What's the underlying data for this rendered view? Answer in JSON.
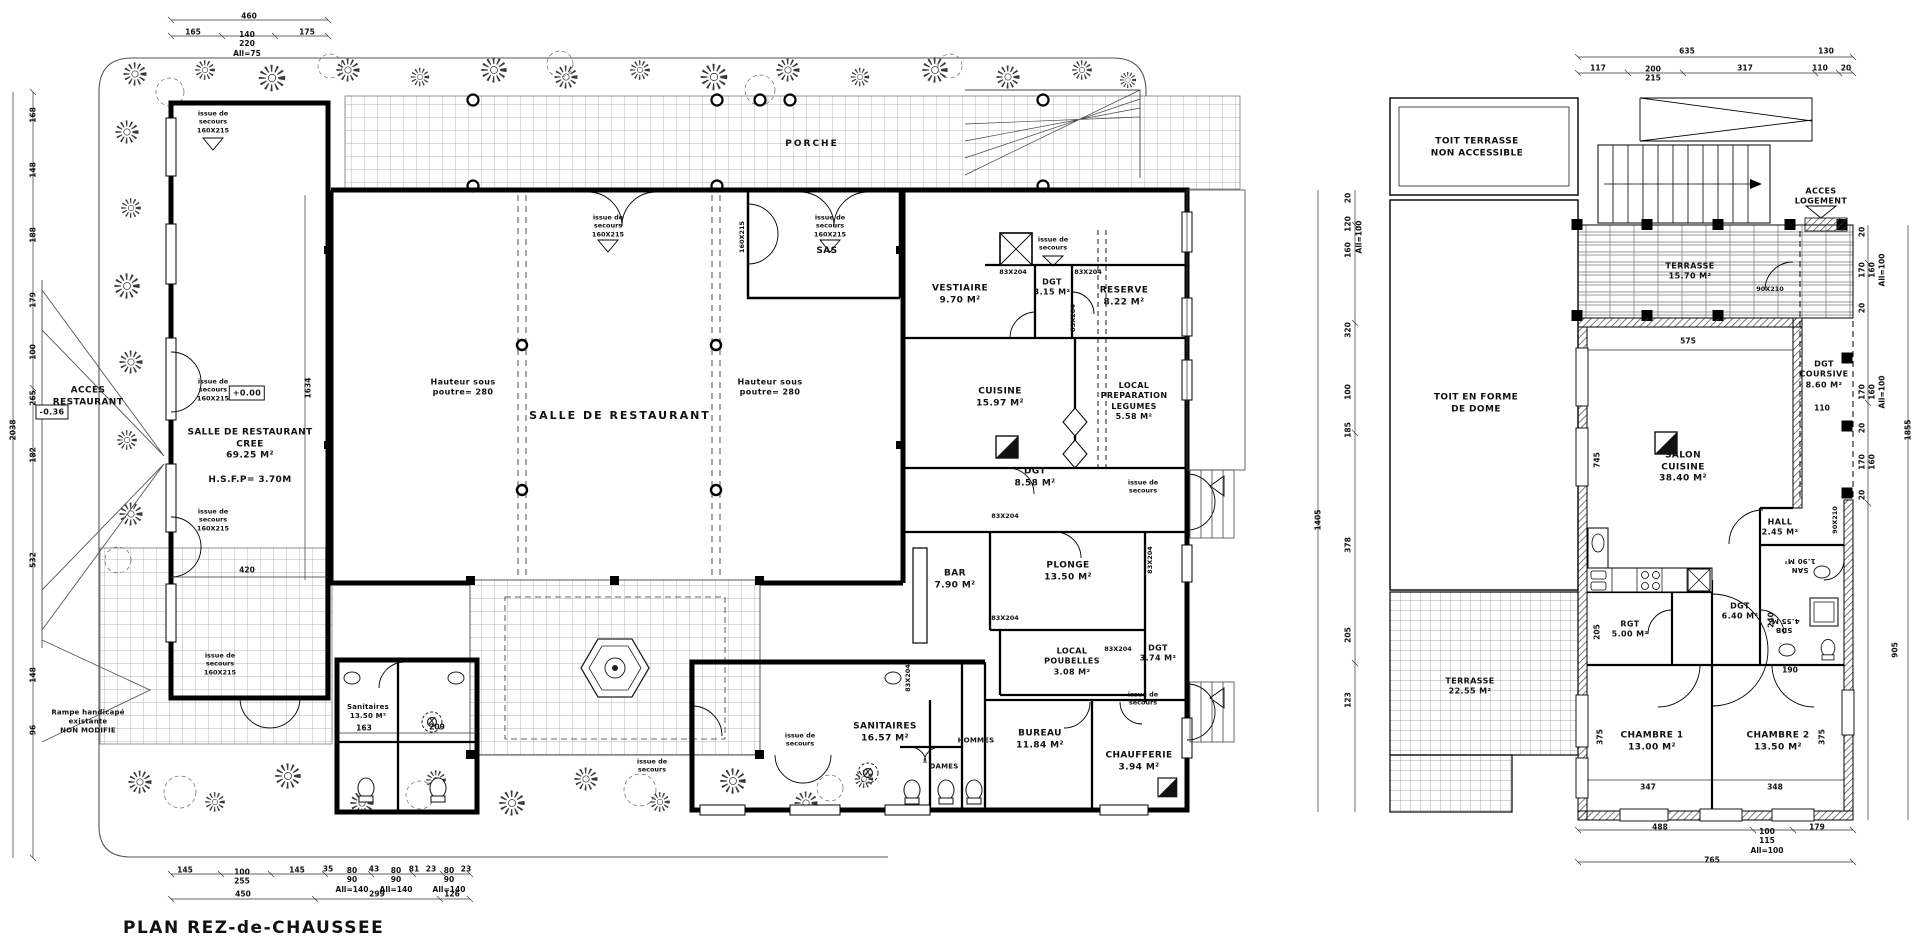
{
  "title": "PLAN REZ-de-CHAUSSEE",
  "common": {
    "issue2": "issue de\nsecours",
    "issue3": "issue de\nsecours\n160X215",
    "door83": "83X204",
    "door160": "160X215",
    "door90": "90X210",
    "hauteur": "Hauteur sous\npoutre= 280"
  },
  "left": {
    "rooms": {
      "salle_cree": "SALLE DE RESTAURANT\nCREE\n69.25 M²",
      "salle_cree_h": "H.S.F.P= 3.70M",
      "salle": "SALLE DE RESTAURANT",
      "porche": "PORCHE",
      "sas": "SAS",
      "vestiaire": "VESTIAIRE\n9.70 M²",
      "dgt_haut": "DGT\n3.15 M²",
      "reserve": "RESERVE\n8.22 M²",
      "cuisine": "CUISINE\n15.97 M²",
      "local_prep": "LOCAL\nPREPARATION\nLEGUMES\n5.58 M²",
      "dgt_mid": "DGT\n8.58 M²",
      "plonge": "PLONGE\n13.50 M²",
      "bar": "BAR\n7.90 M²",
      "poubelles": "LOCAL\nPOUBELLES\n3.08 M²",
      "dgt_bas": "DGT\n3.74 M²",
      "bureau": "BUREAU\n11.84 M²",
      "chaufferie": "CHAUFFERIE\n3.94 M²",
      "sanitaires": "SANITAIRES\n16.57 M²",
      "hommes": "HOMMES",
      "dames": "DAMES",
      "sanitaires_exist": "Sanitaires\n13.50 M²",
      "acces": "ACCES\nRESTAURANT",
      "rampe": "Rampe handicapé\nexistante\nNON MODIFIE"
    },
    "levels": {
      "zero": "+0.00",
      "minus": "-0.36"
    },
    "dims": {
      "t460": "460",
      "t165": "165",
      "t140": "140\n220\nAll=75",
      "t175": "175",
      "b145": "145",
      "b100": "100\n255",
      "b35": "35",
      "b80": "80\n90\nAll=140",
      "b43": "43",
      "b81": "81",
      "b23": "23",
      "b450": "450",
      "b299": "299",
      "b126": "126",
      "l168": "168",
      "l148": "148",
      "l188": "188",
      "l179": "179",
      "l100": "100",
      "l265": "265",
      "l182": "182",
      "l532": "532",
      "l96": "96",
      "l2038": "2038",
      "v1634": "1634",
      "v420": "420",
      "d163": "163",
      "d209": "209"
    }
  },
  "right": {
    "rooms": {
      "toit_terrasse": "TOIT TERRASSE\nNON ACCESSIBLE",
      "acces_logement": "ACCES\nLOGEMENT",
      "terrasse_haute": "TERRASSE\n15.70 M²",
      "toit_dome": "TOIT EN FORME\nDE DOME",
      "dgt_coursive": "DGT\nCOURSIVE\n8.60 M²",
      "salon": "SALON\nCUISINE\n38.40 M²",
      "hall": "HALL\n2.45 M²",
      "san": "SAN\n1.90 M²",
      "dgt": "DGT\n6.40 M²",
      "rgt": "RGT\n5.00 M²",
      "sdb": "SDB\n4.55 M²",
      "terrasse_basse": "TERRASSE\n22.55 M²",
      "chambre1": "CHAMBRE 1\n13.00 M²",
      "chambre2": "CHAMBRE 2\n13.50 M²"
    },
    "dims": {
      "t635": "635",
      "t130": "130",
      "t117": "117",
      "t200": "200\n215",
      "t317": "317",
      "t110": "110",
      "n20": "20",
      "i575": "575",
      "i745": "745",
      "i110": "110",
      "i205": "205",
      "i375": "375",
      "i347": "347",
      "i348": "348",
      "i240": "240",
      "i190": "190",
      "n170": "170",
      "n160": "160",
      "nall": "All=100",
      "r905": "905",
      "r1855": "1855",
      "l120": "120",
      "l160": "160",
      "l320": "320",
      "l100": "100",
      "l185": "185",
      "l1405": "1405",
      "l378": "378",
      "l205": "205",
      "l123": "123",
      "b488": "488",
      "b100": "100\n115\nAll=100",
      "b179": "179",
      "b765": "765"
    }
  }
}
